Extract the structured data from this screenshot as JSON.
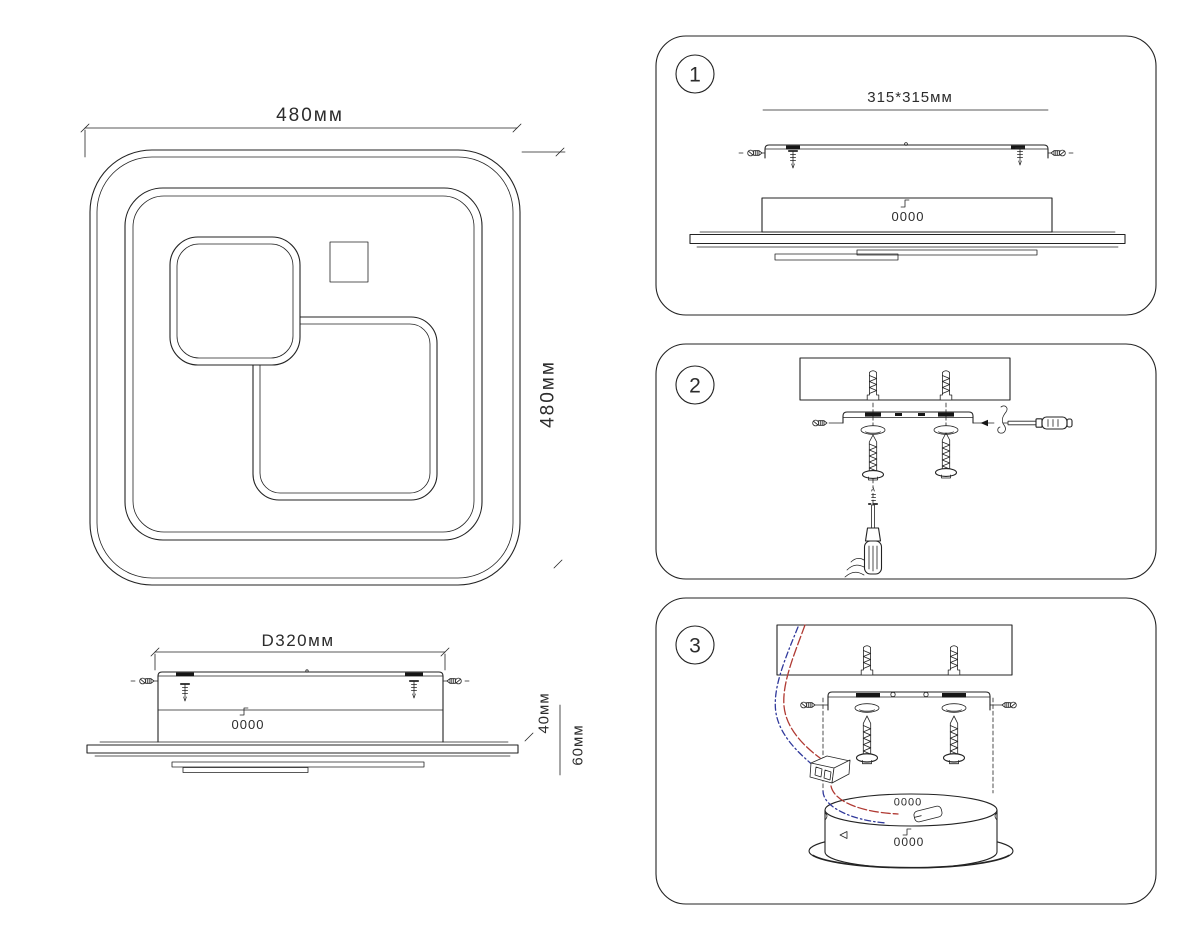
{
  "document": {
    "type": "ceiling-light installation diagram",
    "language": "ru"
  },
  "colors": {
    "line": "#232323",
    "wire_red": "#b03a33",
    "wire_blue": "#30399b",
    "background": "#ffffff"
  },
  "top_view": {
    "width_label": "480мм",
    "height_label": "480мм"
  },
  "side_view": {
    "width_label": "D320мм",
    "height_label_inner": "40мм",
    "height_label_outer": "60мм",
    "connector_label": "0000"
  },
  "panels": [
    {
      "number": "1",
      "plate_label": "315*315мм",
      "connector_label": "0000"
    },
    {
      "number": "2"
    },
    {
      "number": "3",
      "connector_label_top": "0000",
      "connector_label_front": "0000"
    }
  ]
}
